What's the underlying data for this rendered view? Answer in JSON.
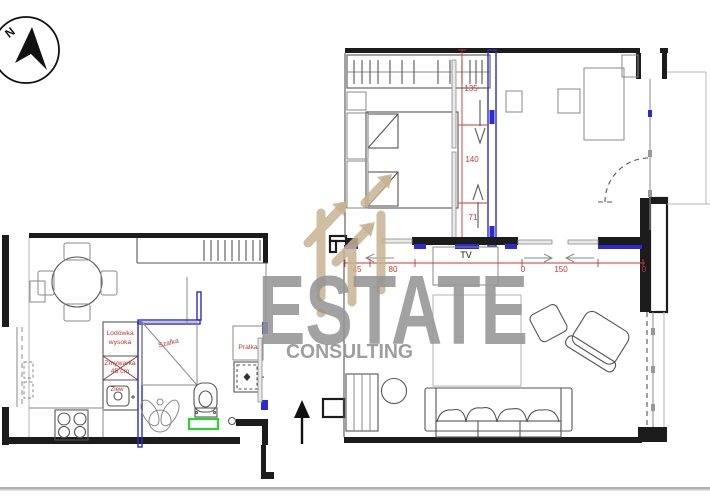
{
  "compass": {
    "label": "N"
  },
  "watermark": {
    "brand": "ESTATE",
    "tagline": "CONSULTING"
  },
  "labels": {
    "fridge_line1": "Lodówka",
    "fridge_line2": "wysoka",
    "dishwasher_line1": "Zmywarka",
    "dishwasher_line2": "45 cm",
    "sink": "Zlew",
    "cabinet": "Szafka",
    "washer": "Pralka",
    "tv": "TV"
  },
  "dimensions": {
    "bedroom_wall": [
      "135",
      "140",
      "71"
    ],
    "tv_wall": [
      "45",
      "80",
      "0",
      "150",
      "0"
    ]
  },
  "colors": {
    "wall_black": "#1c1c1c",
    "new_wall_blue": "#2b2bd0",
    "dimension_red": "#cc3333",
    "mat_green": "#2fd32f",
    "watermark_gray": "#969696",
    "logo_tan": "#c7b391",
    "furniture_gray": "#8a8a8a",
    "separator_gray": "#b0b0b0"
  }
}
